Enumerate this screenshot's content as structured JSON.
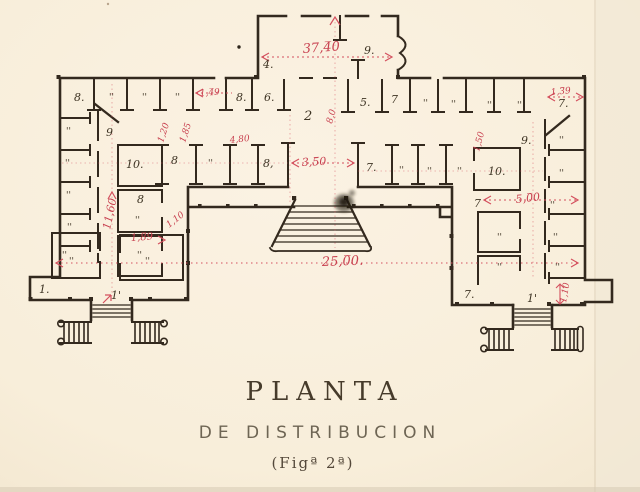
{
  "title_block": {
    "line1": "PLANTA",
    "line2": "DE DISTRIBUCION",
    "line3": "(Figª 2ª)"
  },
  "colors": {
    "paper": "#f8eedd",
    "ink": "#33291e",
    "label_ink": "#3d3323",
    "annotation_red": "#c8404f",
    "faint_red": "#e08a94"
  },
  "plan": {
    "room_labels": [
      {
        "t": "4.",
        "x": 263,
        "y": 68
      },
      {
        "t": "9.",
        "x": 364,
        "y": 54
      },
      {
        "t": "8.",
        "x": 74,
        "y": 101
      },
      {
        "t": "''",
        "x": 109,
        "y": 100,
        "s": 9
      },
      {
        "t": "''",
        "x": 142,
        "y": 100,
        "s": 9
      },
      {
        "t": "''",
        "x": 175,
        "y": 100,
        "s": 9
      },
      {
        "t": "8.",
        "x": 236,
        "y": 101
      },
      {
        "t": "6.",
        "x": 264,
        "y": 101
      },
      {
        "t": "5.",
        "x": 360,
        "y": 106
      },
      {
        "t": "7",
        "x": 391,
        "y": 103
      },
      {
        "t": "''",
        "x": 423,
        "y": 106,
        "s": 9
      },
      {
        "t": "''",
        "x": 451,
        "y": 107,
        "s": 9
      },
      {
        "t": "''",
        "x": 487,
        "y": 108,
        "s": 9
      },
      {
        "t": "''",
        "x": 517,
        "y": 108,
        "s": 9
      },
      {
        "t": "7.",
        "x": 558,
        "y": 107
      },
      {
        "t": "9",
        "x": 106,
        "y": 136
      },
      {
        "t": "9.",
        "x": 521,
        "y": 144
      },
      {
        "t": "2",
        "x": 304,
        "y": 120,
        "s": 13
      },
      {
        "t": "10.",
        "x": 126,
        "y": 168
      },
      {
        "t": "8",
        "x": 171,
        "y": 164
      },
      {
        "t": "''",
        "x": 208,
        "y": 166,
        "s": 9
      },
      {
        "t": "8,",
        "x": 263,
        "y": 167
      },
      {
        "t": "7.",
        "x": 366,
        "y": 171
      },
      {
        "t": "''",
        "x": 399,
        "y": 173,
        "s": 9
      },
      {
        "t": "''",
        "x": 427,
        "y": 174,
        "s": 9
      },
      {
        "t": "''",
        "x": 457,
        "y": 174,
        "s": 9
      },
      {
        "t": "10.",
        "x": 488,
        "y": 175
      },
      {
        "t": "''",
        "x": 66,
        "y": 134,
        "s": 9
      },
      {
        "t": "''",
        "x": 65,
        "y": 166,
        "s": 9
      },
      {
        "t": "''",
        "x": 66,
        "y": 198,
        "s": 9
      },
      {
        "t": "''",
        "x": 67,
        "y": 230,
        "s": 9
      },
      {
        "t": "''",
        "x": 62,
        "y": 258,
        "s": 9
      },
      {
        "t": "8",
        "x": 137,
        "y": 203
      },
      {
        "t": "''",
        "x": 135,
        "y": 223,
        "s": 9
      },
      {
        "t": "''",
        "x": 137,
        "y": 258,
        "s": 9
      },
      {
        "t": "''",
        "x": 559,
        "y": 143,
        "s": 9
      },
      {
        "t": "''",
        "x": 559,
        "y": 176,
        "s": 9
      },
      {
        "t": "7",
        "x": 474,
        "y": 207
      },
      {
        "t": "''",
        "x": 550,
        "y": 208,
        "s": 9
      },
      {
        "t": "''",
        "x": 553,
        "y": 240,
        "s": 9
      },
      {
        "t": "''",
        "x": 497,
        "y": 240,
        "s": 9
      },
      {
        "t": "''",
        "x": 555,
        "y": 270,
        "s": 9
      },
      {
        "t": "''",
        "x": 497,
        "y": 270,
        "s": 9
      },
      {
        "t": "7.",
        "x": 464,
        "y": 298
      },
      {
        "t": "1'",
        "x": 527,
        "y": 302
      },
      {
        "t": "1.",
        "x": 39,
        "y": 293
      },
      {
        "t": "1'",
        "x": 111,
        "y": 299
      },
      {
        "t": "''",
        "x": 69,
        "y": 264,
        "s": 9
      },
      {
        "t": "''",
        "x": 145,
        "y": 264,
        "s": 9
      }
    ],
    "red_dimensions": [
      {
        "t": "37,4̅0",
        "x": 303,
        "y": 53,
        "s": 13,
        "r": -4
      },
      {
        "t": "1,4̅9",
        "x": 200,
        "y": 96,
        "s": 9,
        "r": -4
      },
      {
        "t": "4,80",
        "x": 230,
        "y": 143,
        "s": 9,
        "r": -6
      },
      {
        "t": "1,3̅9",
        "x": 551,
        "y": 95,
        "s": 9,
        "r": -5
      },
      {
        "t": "3,5̅0",
        "x": 302,
        "y": 166,
        "s": 11,
        "r": -3
      },
      {
        "t": "5,0̅0",
        "x": 516,
        "y": 203,
        "s": 11,
        "r": -6
      },
      {
        "t": "25,0̅0.",
        "x": 322,
        "y": 266,
        "s": 13,
        "r": -2
      },
      {
        "t": "11,60",
        "x": 110,
        "y": 230,
        "s": 11,
        "r": -78
      },
      {
        "t": "1,20",
        "x": 163,
        "y": 143,
        "s": 9,
        "r": -72
      },
      {
        "t": "1,85",
        "x": 185,
        "y": 143,
        "s": 9,
        "r": -72
      },
      {
        "t": "8,0",
        "x": 332,
        "y": 124,
        "s": 9,
        "r": -75
      },
      {
        "t": "1,50",
        "x": 479,
        "y": 152,
        "s": 9,
        "r": -75
      },
      {
        "t": "1,8̅9",
        "x": 131,
        "y": 241,
        "s": 10,
        "r": -4
      },
      {
        "t": "1,10",
        "x": 169,
        "y": 228,
        "s": 9,
        "r": -38
      },
      {
        "t": "1,10",
        "x": 566,
        "y": 303,
        "s": 9,
        "r": -80
      }
    ]
  }
}
